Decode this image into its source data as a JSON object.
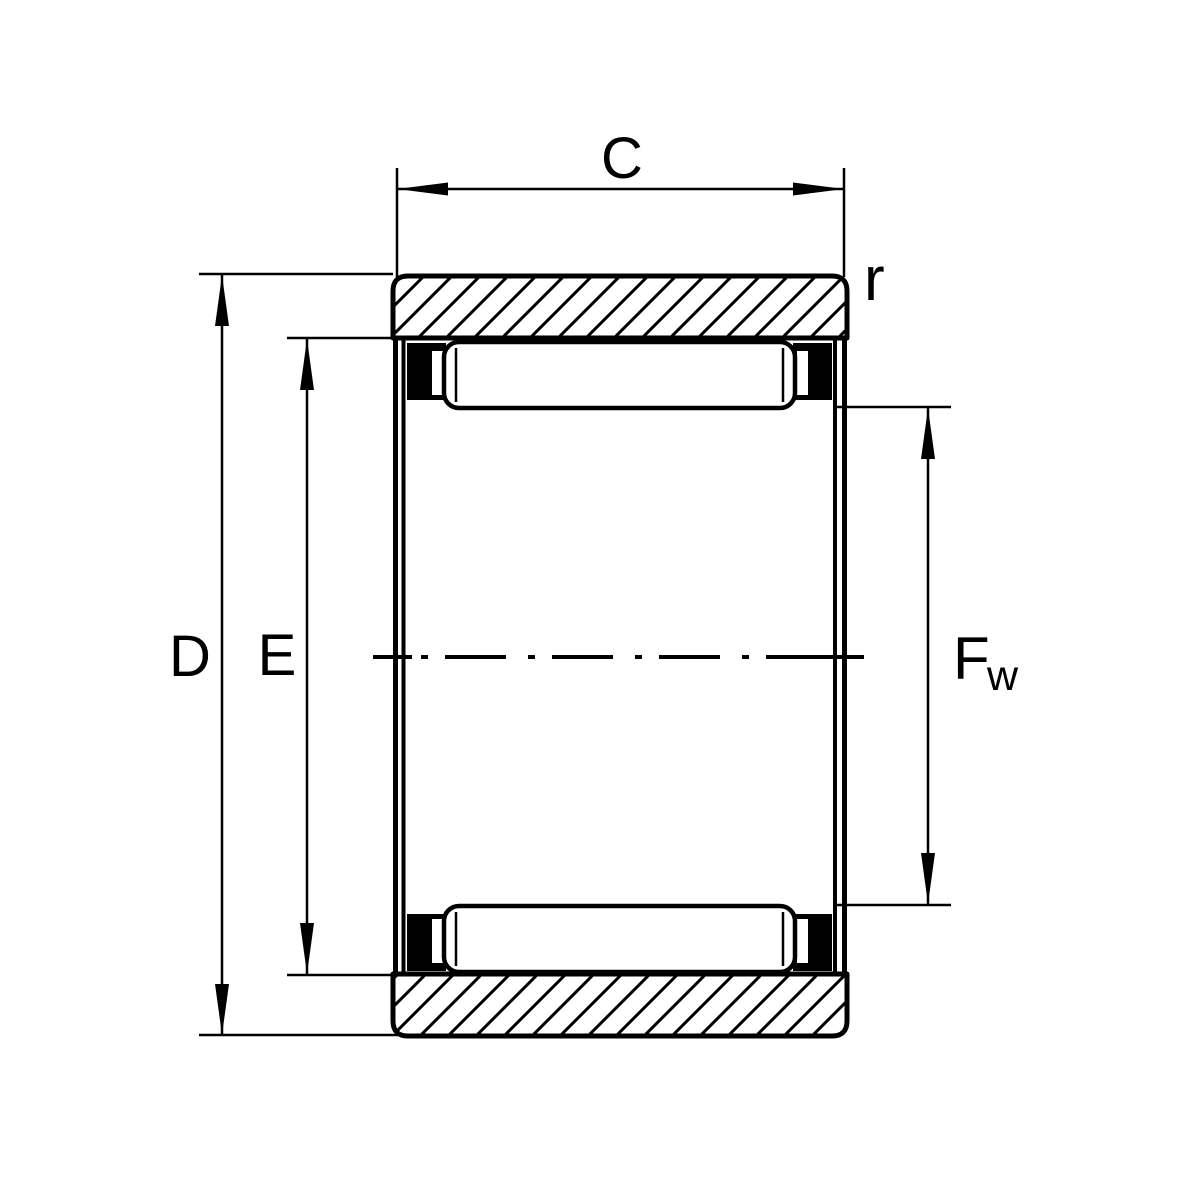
{
  "diagram": {
    "kind": "bearing-cross-section-technical-drawing",
    "subject": "needle roller bearing without inner ring, axial cross-section with dimension callouts",
    "labels": {
      "width_c": "C",
      "corner_radius_r": "r",
      "outer_diameter_d": "D",
      "raceway_diameter_e": "E",
      "under_roller_diameter_f": "F",
      "under_roller_subscript_w": "w"
    },
    "colors": {
      "line": "#000000",
      "background": "#ffffff",
      "cage_fill": "#000000",
      "roller_fill": "#ffffff"
    },
    "features": {
      "hatch_direction": "bottom-left-to-top-right",
      "center_axis_style": "dash-dot",
      "dimension_c": "outer ring width (horizontal, top)",
      "dimension_d": "outer diameter (vertical, far left)",
      "dimension_e": "raceway diameter (vertical, inner left)",
      "dimension_fw": "diameter under rollers (vertical, right)",
      "dimension_r": "outer ring corner radius (top right)"
    }
  }
}
